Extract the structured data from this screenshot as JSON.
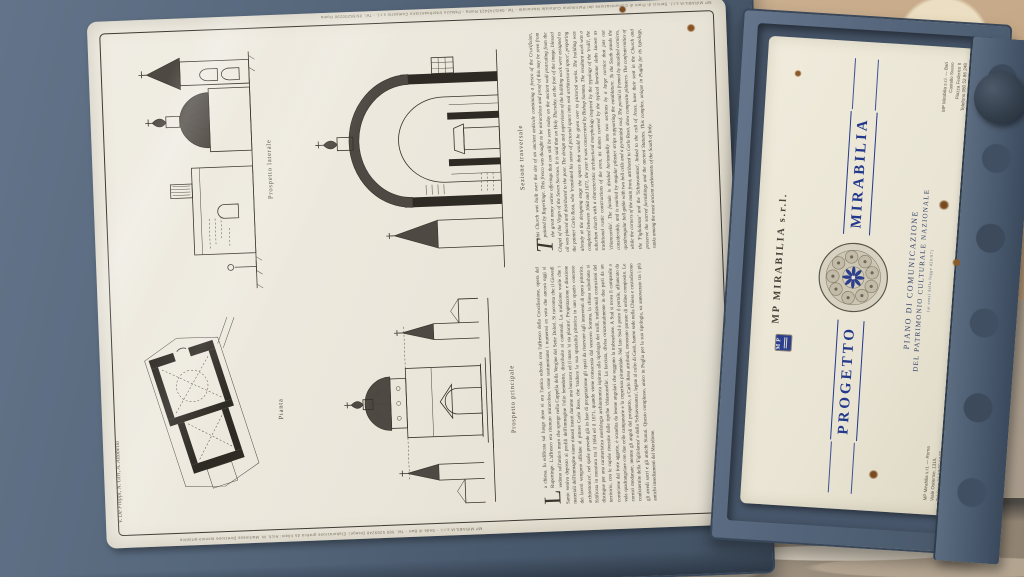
{
  "colors": {
    "frame_blue": "#55657a",
    "frame_dark": "#39475a",
    "sheet_cream": "#ebe7dc",
    "card_cream": "#ece7d8",
    "ink": "#36312a",
    "brand_blue": "#23398b",
    "wall_tan": "#c6ab89",
    "pavement_stone": "#a0937f"
  },
  "sheet": {
    "authors_note": "V. De Filippi, N. Giri, A. Altobello",
    "top_edge_print": "MP MIRABILIA s.r.l.  Servizi di Piani di Comunicazione del Patrimonio Culturale Nazionale - Tel. 06/5743423 Roma  -  Palazzo Interfinanziario Comparto s.r.l. - Tel. 06/56200298 Roma",
    "bottom_edge_print": "MP MIRABILIA s.r.l. - Sede di Bari - Tel. 080 5289248   Disegni: Elaborazione grafica da rilievi: Arch. M. Martinese   Direzione tecnico-artistica",
    "figures": [
      {
        "caption": "Pianta"
      },
      {
        "caption": "Prospetto laterale"
      },
      {
        "caption": "Prospetto principale"
      },
      {
        "caption": "Sezione trasversale"
      }
    ],
    "text_columns": {
      "italian": {
        "dropcap": "L",
        "body": "a chiesa, fu edificata sul luogo dove vi era l'antica edicola con l'affresco della Crocifissione, opera del Rupertinge. L'affresco era ritenuto miracoloso, come testimoniano i numerosi ex voto che ancora oggi si vedono sull'antico muro che sporge nella Cappella della Vergine dei Sette Dolori. Si racconta che il Giovedì Santo veniva deposto ai profili dell'immagine l'olio benedetto, distribuito ai cantonali. La tradizione vuole che i materiali dell'immagine siano rimasti intatti durante una burrasca ed il mare 'si sia placato'. Progettazione e direzione dei lavori vengono affidate al pittore Carlo Rosa, che 'traduce la sua spazialità pittorica in uno spazio concreto architettonico', nel quale prevede già in fase di progettazione gli spazi da riservare agli interventi di opera pittorica. Edificata in muratura tra il 1664 ed il 1671, quando viene consacrata dal vescovo Somma, la chiesa suburbana si distingue per una caratteristica morfologia architettonica ispirata alla tipologia dei trulli, tradizionali costruzioni del territorio, con le cupole rivestite dalle tipiche 'chiancarelle'. La facciata, divisa orizzontalmente in due parti da un cornicione dal forte aggetto, è scandita da lesene angolari che reggono la trabeazione. A Sud si trova il campanile a vela quadrangolare con due celle campanarie e la copertura piramidale. Nel lato Sud è posto il portale, affiancato da cornici modanate, mentre gli angoli del prospetto, a Carlo Rosa attribuiti, mostrano paraste di ordine composito. Le confraternite della 'Figliolanza' e della 'Schiavonanza', legate al culto di Gesù, hanno sede nella Chiesa e custodiscono gli arredi sacri e gli antichi Statuti. Questo complesso, unico in Puglia per la sua tipologia, va annoverato tra i più antichi insediamenti del Meridione."
      },
      "english": {
        "dropcap": "T",
        "body": "his Church was built over the site of an ancient aedicule containing a fresco of the Crucifixion, painted by Rupertinge. This fresco was thought to be miraculous and proof of this may be seen from the great many votive offerings that can still be seen today on the ancient wall protruding from the Chapel of the Virgin of the Seven Sorrows. It is said that on Holy Thursday, at the foot of the image, blessed oil was placed and distributed to the poor. The design and supervision of the building work were assigned to the painter Carlo Rosa, who 'translated his sense of pictorial space into real architectural space', preparing already at the designing stage the spaces that would be given over to pictorial works. The building was completed between 1664 and 1671, the year it was consecrated by Bishop Somma. The resultant work was a suburban church with a characteristic architectural morphology inspired by the typology of the 'trulli', the traditional rustic constructions of the area, its domes covered by the typical limestone slabs known as 'chiancarelle'. The facade is divided horizontally into two sections by a large cornice that juts out considerably, and is marked by angular pilaster strips supporting the entablature. To the South stands the quadrangular bell gable with two bell cells and a pyramidal roof. The portal is framed by moulded cornices, while the corners of the main front, attributed to Carlo Rosa, show composite pilasters. The confraternities of the 'Figliolanza' and the 'Schiavonanza', linked to the cult of Jesus, have their seat in the Church and preserve the sacred furnishings and the ancient Statutes. This complex, unique in Puglia for its typology, ranks among the most ancient settlements of the South of Italy."
      }
    }
  },
  "card": {
    "logo_text": "MP",
    "company": "MP MIRABILIA s.r.l.",
    "word_left": "PROGETTO",
    "word_right": "MIRABILIA",
    "plan_line1": "PIANO DI COMUNICAZIONE",
    "plan_line2": "DEL PATRIMONIO CULTURALE NAZIONALE",
    "plan_line3": "(ai sensi della legge 420/97)",
    "address_roma": [
      "MP Mirabilia s.r.l. — Roma",
      "Viale Ostiense, 131/L",
      "Telefono: 06 57 30 14 35"
    ],
    "address_bari": [
      "MP Mirabilia s.r.l. — Bari",
      "Castello Svevo",
      "Piazza Federico II",
      "Telefono 080 52 86 248"
    ]
  }
}
